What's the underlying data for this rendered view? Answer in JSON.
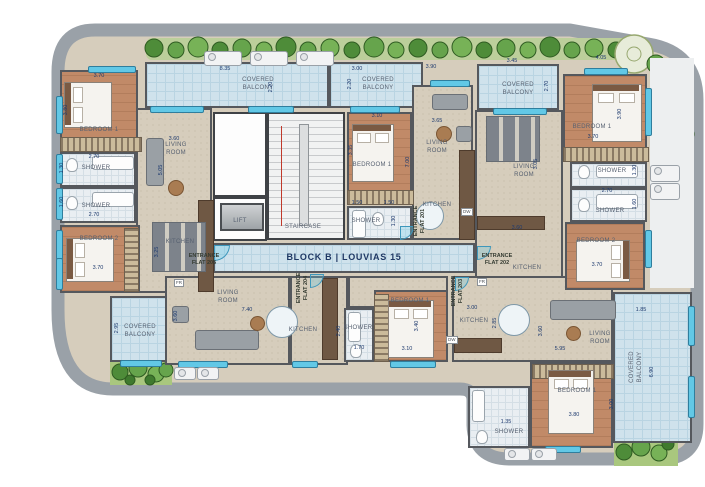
{
  "block_label": "BLOCK B | LOUVIAS 15",
  "room_labels": {
    "bedroom1": "BEDROOM 1",
    "bedroom2": "BEDROOM 2",
    "living_room": "LIVING ROOM",
    "kitchen": "KITCHEN",
    "shower": "SHOWER",
    "covered_balcony": "COVERED BALCONY",
    "lift": "LIFT",
    "staircase": "STAIRCASE"
  },
  "entrances": {
    "flat201": "ENTRANCE FLAT 201",
    "flat202": "ENTRANCE FLAT 202",
    "flat203": "ENTRANCE FLAT 203",
    "flat204": "ENTRANCE FLAT 204",
    "flat205": "ENTRANCE FLAT 205"
  },
  "appliances": {
    "fridge": "FR",
    "dishwasher": "DW"
  },
  "dims": {
    "b1_w": "8.35",
    "b1_d": "2.20",
    "b2_w": "3.00",
    "b2_d": "2.20",
    "win201_w": "3.90",
    "b3_w": "3.45",
    "b3_d": "2.70",
    "bd1_202_top": "4.05",
    "bd1_205_w": "3.70",
    "bd1_205_h": "3.80",
    "sh1_205_w": "2.70",
    "sh1_205_h": "1.30",
    "sh2_205_w": "2.70",
    "sh2_205_h": "1.60",
    "bd2_205_w": "3.70",
    "liv_205_w": "3.60",
    "liv_205_h": "5.05",
    "kit_205_h": "3.25",
    "bd1_201_w": "3.10",
    "bd1_201_h": "3.35",
    "liv_201_w": "3.65",
    "flat201_d": "7.00",
    "sh_201_w1": "1.50",
    "sh_201_w2": "1.50",
    "sh_201_h": "1.30",
    "bd1_202_w": "3.70",
    "bd1_202_h": "3.90",
    "liv_202_h": "3.05",
    "sh1_202_h": "1.30",
    "sh_202_w": "2.70",
    "sh2_202_h": "1.60",
    "bd2_202_w": "3.70",
    "kit_202_w": "3.60",
    "liv_204_w": "7.40",
    "liv_204_h": "3.60",
    "b4_d": "2.95",
    "sh_204_h": "2.40",
    "sh_204_w": "1.70",
    "bd1_204_w": "3.10",
    "bd1_204_h": "3.40",
    "kit_203_w": "3.00",
    "kit_203_h": "2.85",
    "liv_203_w": "5.95",
    "liv_203_h": "3.60",
    "bd1_203_w": "3.80",
    "bd1_203_h": "3.00",
    "sh_203_w": "1.35",
    "b5_w": "1.85",
    "b5_d": "6.90"
  },
  "colors": {
    "outline": "#9aa1a8",
    "wall": "#55585d",
    "wood_floor": "#c18a68",
    "interior_floor": "#d6cdbc",
    "balcony_tile": "#cfe2ec",
    "shower_tile": "#e9eef2",
    "hedge_green": "#5e9a42",
    "window_blue": "#62c8e6",
    "dimension_text": "#1e3a6e"
  }
}
